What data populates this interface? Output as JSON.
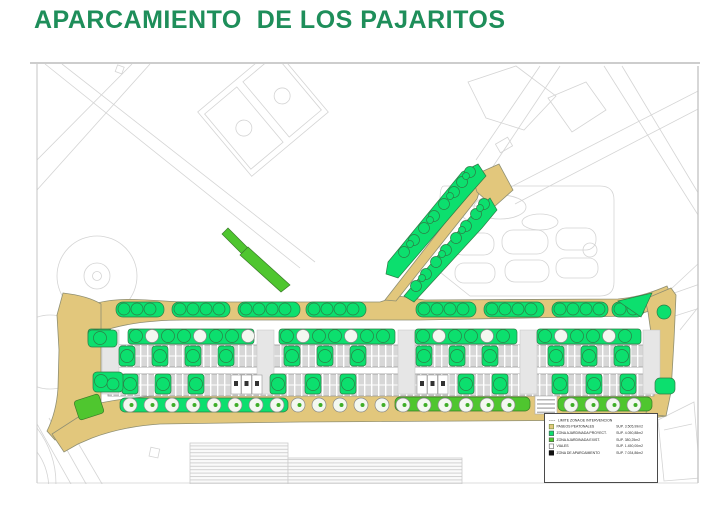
{
  "page": {
    "title": "APARCAMIENTO  DE LOS PAJARITOS"
  },
  "colors": {
    "title": "#1E8E5A",
    "tan": "#E2C77C",
    "tan-stroke": "#8F8F73",
    "green-project": "#0CDF6E",
    "green-exist": "#4FC62F",
    "parking-fill": "#D7D7D7",
    "parking-stroke": "#9A9A9A",
    "bg-line": "#D4D4D4",
    "legend-border": "#4A4A4A"
  },
  "legend": {
    "items": [
      {
        "label": "LIMITE ZONA DE INTERVENCION",
        "sup": ""
      },
      {
        "label": "PASEOS PEATONALES",
        "sup": "SUP.  3.505,99m2"
      },
      {
        "label": "ZONA AJARDINADA PROYECT.",
        "sup": "SUP.  4.050,88m2"
      },
      {
        "label": "ZONA AJARDINADA EXIST.",
        "sup": "SUP.  380,25m2"
      },
      {
        "label": "VIALES",
        "sup": "SUP.  1.450,00m2"
      },
      {
        "label": "ZONA DE APARCAMIENTO",
        "sup": "SUP.  7.034,86m2"
      }
    ]
  }
}
